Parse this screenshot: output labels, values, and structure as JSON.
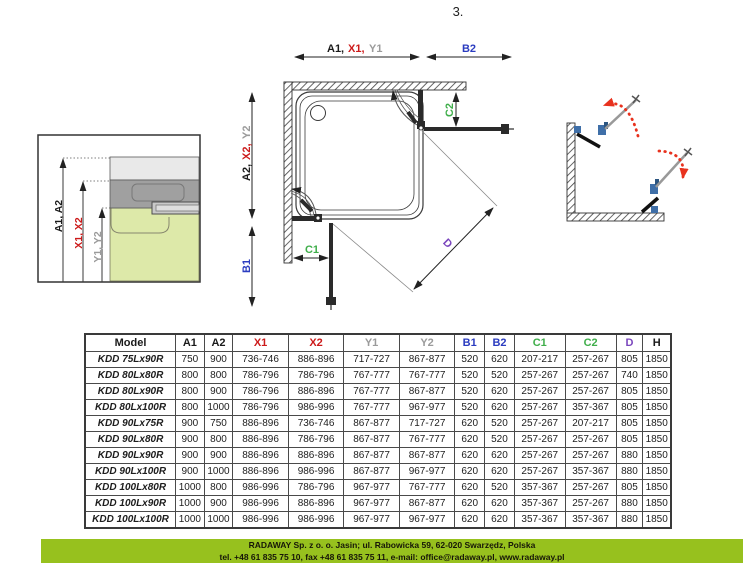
{
  "page_number": "3.",
  "diagram": {
    "dim_labels": {
      "a1": "A1,",
      "x1": "X1,",
      "y1": "Y1",
      "b2": "B2",
      "a2": "A2,",
      "x2": "X2,",
      "y2": "Y2",
      "b1": "B1",
      "c1": "C1",
      "c2": "C2",
      "d": "D"
    },
    "detail_labels": {
      "a": "A1, A2",
      "x": "X1, X2",
      "y": "Y1, Y2"
    },
    "colors": {
      "dim_black": "#1a1a1a",
      "dim_red": "#cc1a1a",
      "dim_gray": "#9b9b9b",
      "dim_blue": "#2b3cc0",
      "dim_green": "#3fae4a",
      "dim_purple": "#7a46bd",
      "swing_arrow_red": "#e8321e",
      "footer_green": "#97c11e"
    }
  },
  "table": {
    "columns": [
      {
        "label": "Model",
        "color": "#1a1a1a"
      },
      {
        "label": "A1",
        "color": "#1a1a1a"
      },
      {
        "label": "A2",
        "color": "#1a1a1a"
      },
      {
        "label": "X1",
        "color": "#cc1a1a"
      },
      {
        "label": "X2",
        "color": "#cc1a1a"
      },
      {
        "label": "Y1",
        "color": "#9b9b9b"
      },
      {
        "label": "Y2",
        "color": "#9b9b9b"
      },
      {
        "label": "B1",
        "color": "#2b3cc0"
      },
      {
        "label": "B2",
        "color": "#2b3cc0"
      },
      {
        "label": "C1",
        "color": "#3fae4a"
      },
      {
        "label": "C2",
        "color": "#3fae4a"
      },
      {
        "label": "D",
        "color": "#7a46bd"
      },
      {
        "label": "H",
        "color": "#1a1a1a"
      }
    ],
    "rows": [
      {
        "model": "KDD 75Lx90R",
        "values": [
          "750",
          "900",
          "736-746",
          "886-896",
          "717-727",
          "867-877",
          "520",
          "620",
          "207-217",
          "257-267",
          "805",
          "1850"
        ]
      },
      {
        "model": "KDD 80Lx80R",
        "values": [
          "800",
          "800",
          "786-796",
          "786-796",
          "767-777",
          "767-777",
          "520",
          "520",
          "257-267",
          "257-267",
          "740",
          "1850"
        ]
      },
      {
        "model": "KDD 80Lx90R",
        "values": [
          "800",
          "900",
          "786-796",
          "886-896",
          "767-777",
          "867-877",
          "520",
          "620",
          "257-267",
          "257-267",
          "805",
          "1850"
        ]
      },
      {
        "model": "KDD 80Lx100R",
        "values": [
          "800",
          "1000",
          "786-796",
          "986-996",
          "767-777",
          "967-977",
          "520",
          "620",
          "257-267",
          "357-367",
          "805",
          "1850"
        ]
      },
      {
        "model": "KDD 90Lx75R",
        "values": [
          "900",
          "750",
          "886-896",
          "736-746",
          "867-877",
          "717-727",
          "620",
          "520",
          "257-267",
          "207-217",
          "805",
          "1850"
        ]
      },
      {
        "model": "KDD 90Lx80R",
        "values": [
          "900",
          "800",
          "886-896",
          "786-796",
          "867-877",
          "767-777",
          "620",
          "520",
          "257-267",
          "257-267",
          "805",
          "1850"
        ]
      },
      {
        "model": "KDD 90Lx90R",
        "values": [
          "900",
          "900",
          "886-896",
          "886-896",
          "867-877",
          "867-877",
          "620",
          "620",
          "257-267",
          "257-267",
          "880",
          "1850"
        ]
      },
      {
        "model": "KDD 90Lx100R",
        "values": [
          "900",
          "1000",
          "886-896",
          "986-996",
          "867-877",
          "967-977",
          "620",
          "620",
          "257-267",
          "357-367",
          "880",
          "1850"
        ]
      },
      {
        "model": "KDD 100Lx80R",
        "values": [
          "1000",
          "800",
          "986-996",
          "786-796",
          "967-977",
          "767-777",
          "620",
          "520",
          "357-367",
          "257-267",
          "805",
          "1850"
        ]
      },
      {
        "model": "KDD 100Lx90R",
        "values": [
          "1000",
          "900",
          "986-996",
          "886-896",
          "967-977",
          "867-877",
          "620",
          "620",
          "357-367",
          "257-267",
          "880",
          "1850"
        ]
      },
      {
        "model": "KDD 100Lx100R",
        "values": [
          "1000",
          "1000",
          "986-996",
          "986-996",
          "967-977",
          "967-977",
          "620",
          "620",
          "357-367",
          "357-367",
          "880",
          "1850"
        ]
      }
    ]
  },
  "footer": {
    "line1": "RADAWAY Sp. z o. o. Jasin; ul. Rabowicka 59, 62-020 Swarzędz, Polska",
    "line2": "tel. +48 61 835 75 10, fax +48 61 835 75 11, e-mail: office@radaway.pl, www.radaway.pl"
  }
}
